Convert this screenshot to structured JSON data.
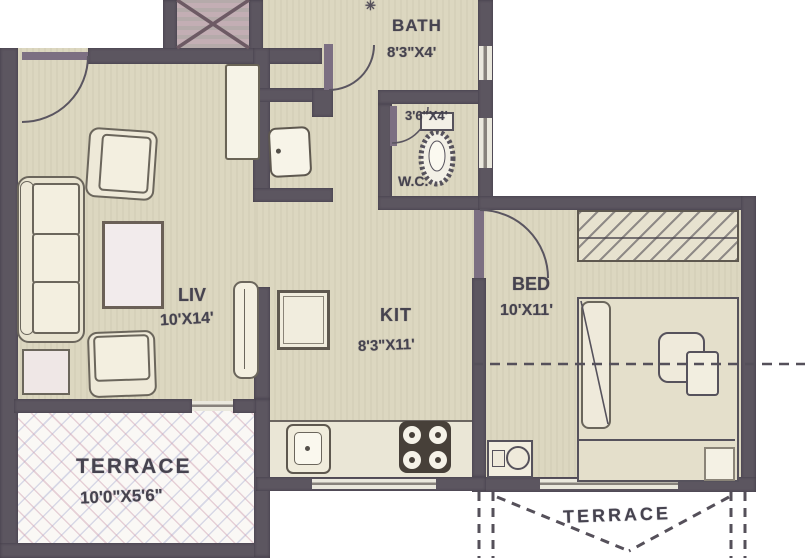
{
  "plan": {
    "type": "residential-floor-plan",
    "rooms": {
      "bath": {
        "label": "BATH",
        "dims": "8'3\"X4'"
      },
      "wc": {
        "label": "W.C.",
        "dims": "3'6\"X4'"
      },
      "kitchen": {
        "label": "KIT",
        "dims": "8'3\"X11'"
      },
      "living": {
        "label": "LIV",
        "dims": "10'X14'"
      },
      "bedroom": {
        "label": "BED",
        "dims": "10'X11'"
      },
      "terrace": {
        "label": "TERRACE",
        "dims": "10'0\"X5'6\""
      },
      "terrace_lower": {
        "label": "TERRACE"
      }
    },
    "marks": {
      "north_asterisk": "✳"
    },
    "colors": {
      "wall": "#5c5660",
      "floor": "#dcd7c0",
      "counter": "#eae6d6",
      "lift_shaft": "#c3aeb4",
      "terrace_tile_pink": "#cda0af",
      "terrace_tile_blue": "#a0a5cd",
      "furniture": "#f3efe0",
      "stove": "#474039",
      "text": "#46434f"
    }
  }
}
